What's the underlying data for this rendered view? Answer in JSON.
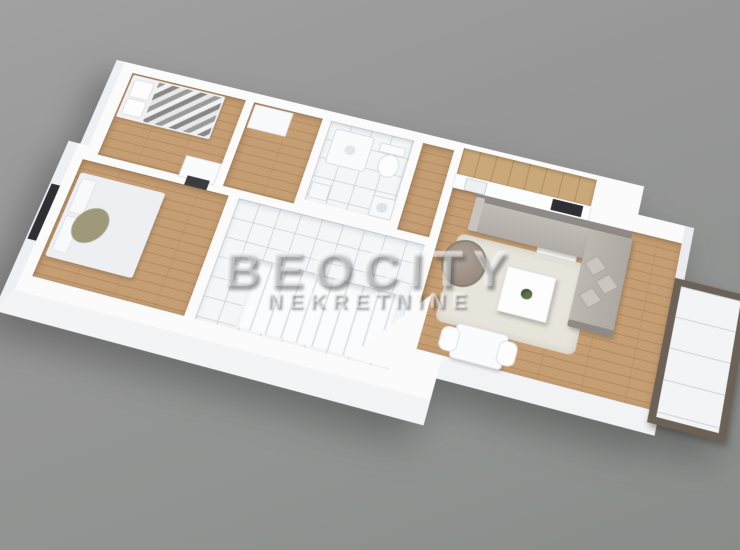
{
  "scene": {
    "type": "3d-floorplan-render",
    "subject": "duplex apartment upper level, isometric top view rotated clockwise on grey studio background",
    "width_px": 740,
    "height_px": 550
  },
  "watermark": {
    "brand": "BEOCITY",
    "tagline": "NEKRETNINE"
  },
  "palette": {
    "background_top": "#a1a1a1",
    "background_bottom": "#898d8a",
    "walls": "#fbfbfc",
    "wall_side_face": "#f2f3f5",
    "wood_floor": "#c69e73",
    "wood_plank_line": "#865f37",
    "tile_floor": "#f4f6f8",
    "tile_line": "#a5b0bc",
    "kitchen_cabinet_wood": "#c9a87a",
    "cooktop_dark": "#2e2e33",
    "sofa_grey": "#b7b2ac",
    "sofa_dark_edge": "#8f8a85",
    "pillow_grey": "#cbc6c0",
    "rug_cream": "#e9e8e1",
    "armchair_taupe": "#9e9289",
    "chevron_blanket_grey": "#9a9a9a",
    "bed_linen_white": "#edeff3",
    "olive_throw": "#8f8a62",
    "balcony_frame_brown": "#6c6156",
    "window_dark": "#2e2e33",
    "watermark_text": "rgba(240,240,240,0.38)"
  },
  "floorplan": {
    "rooms": [
      {
        "id": "bedroom-small",
        "floor": "wood",
        "position": "top-left"
      },
      {
        "id": "corridor",
        "floor": "wood",
        "position": "top-left-center"
      },
      {
        "id": "bathroom",
        "floor": "tile",
        "position": "top-center"
      },
      {
        "id": "hallway",
        "floor": "wood",
        "position": "center"
      },
      {
        "id": "kitchen",
        "floor": "wood",
        "position": "top-right-center"
      },
      {
        "id": "living-room",
        "floor": "wood",
        "position": "right"
      },
      {
        "id": "bedroom-master",
        "floor": "wood",
        "position": "bottom-left"
      },
      {
        "id": "stair-hall",
        "floor": "tile",
        "position": "bottom-center"
      },
      {
        "id": "balcony",
        "floor": "tile-panels",
        "position": "far-right"
      }
    ],
    "furniture": [
      "single-bed-with-chevron-blanket",
      "pillows",
      "dresser",
      "wardrobe",
      "shower-tray",
      "toilet",
      "washing-machine",
      "bathroom-sink",
      "kitchen-cabinets",
      "kitchen-counter",
      "kitchen-sink",
      "cooktop",
      "kitchen-island",
      "corner-sofa",
      "throw-pillows",
      "armchair",
      "coffee-table",
      "potted-plant",
      "area-rug",
      "dining-table",
      "dining-chairs",
      "double-bed",
      "bed-pillows",
      "olive-throw",
      "staircase",
      "entry-door",
      "window",
      "balcony-railing"
    ]
  }
}
